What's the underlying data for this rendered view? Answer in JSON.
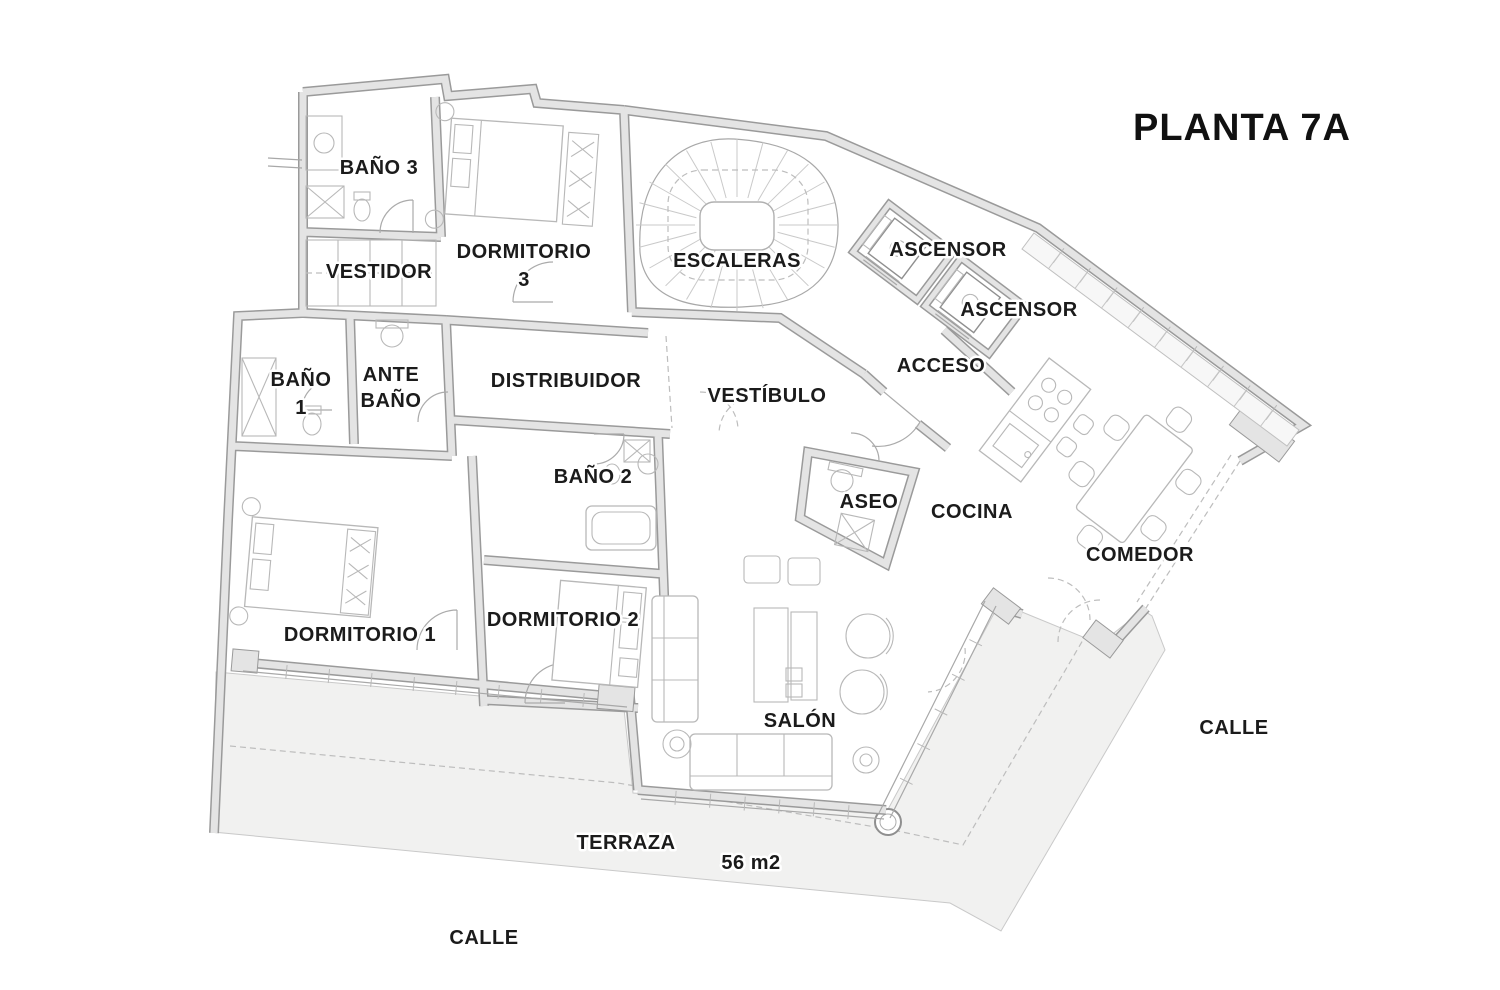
{
  "title": "PLANTA 7A",
  "plan": {
    "rooms": {
      "bano3": {
        "label": "BAÑO 3"
      },
      "dormitorio3": {
        "line1": "DORMITORIO",
        "line2": "3"
      },
      "vestidor": {
        "label": "VESTIDOR"
      },
      "escaleras": {
        "label": "ESCALERAS"
      },
      "ascensor_1": {
        "label": "ASCENSOR"
      },
      "ascensor_2": {
        "label": "ASCENSOR"
      },
      "acceso": {
        "label": "ACCESO"
      },
      "bano1": {
        "line1": "BAÑO",
        "line2": "1"
      },
      "antebano": {
        "line1": "ANTE",
        "line2": "BAÑO"
      },
      "distribuidor": {
        "label": "DISTRIBUIDOR"
      },
      "vestibulo": {
        "label": "VESTÍBULO"
      },
      "bano2": {
        "label": "BAÑO 2"
      },
      "aseo": {
        "label": "ASEO"
      },
      "cocina": {
        "label": "COCINA"
      },
      "comedor": {
        "label": "COMEDOR"
      },
      "dormitorio1": {
        "label": "DORMITORIO 1"
      },
      "dormitorio2": {
        "label": "DORMITORIO 2"
      },
      "salon": {
        "label": "SALÓN"
      }
    },
    "outdoor": {
      "terraza": {
        "label": "TERRAZA",
        "area": "56 m2"
      },
      "calle_bottom": {
        "label": "CALLE"
      },
      "calle_right": {
        "label": "CALLE"
      }
    },
    "colors": {
      "background": "#ffffff",
      "wall_fill": "#e4e4e4",
      "wall_edge": "#9a9a9a",
      "terrace_fill": "#f1f1f0",
      "furniture_line": "#b8b8b8",
      "label_text": "#1b1b1b"
    }
  }
}
